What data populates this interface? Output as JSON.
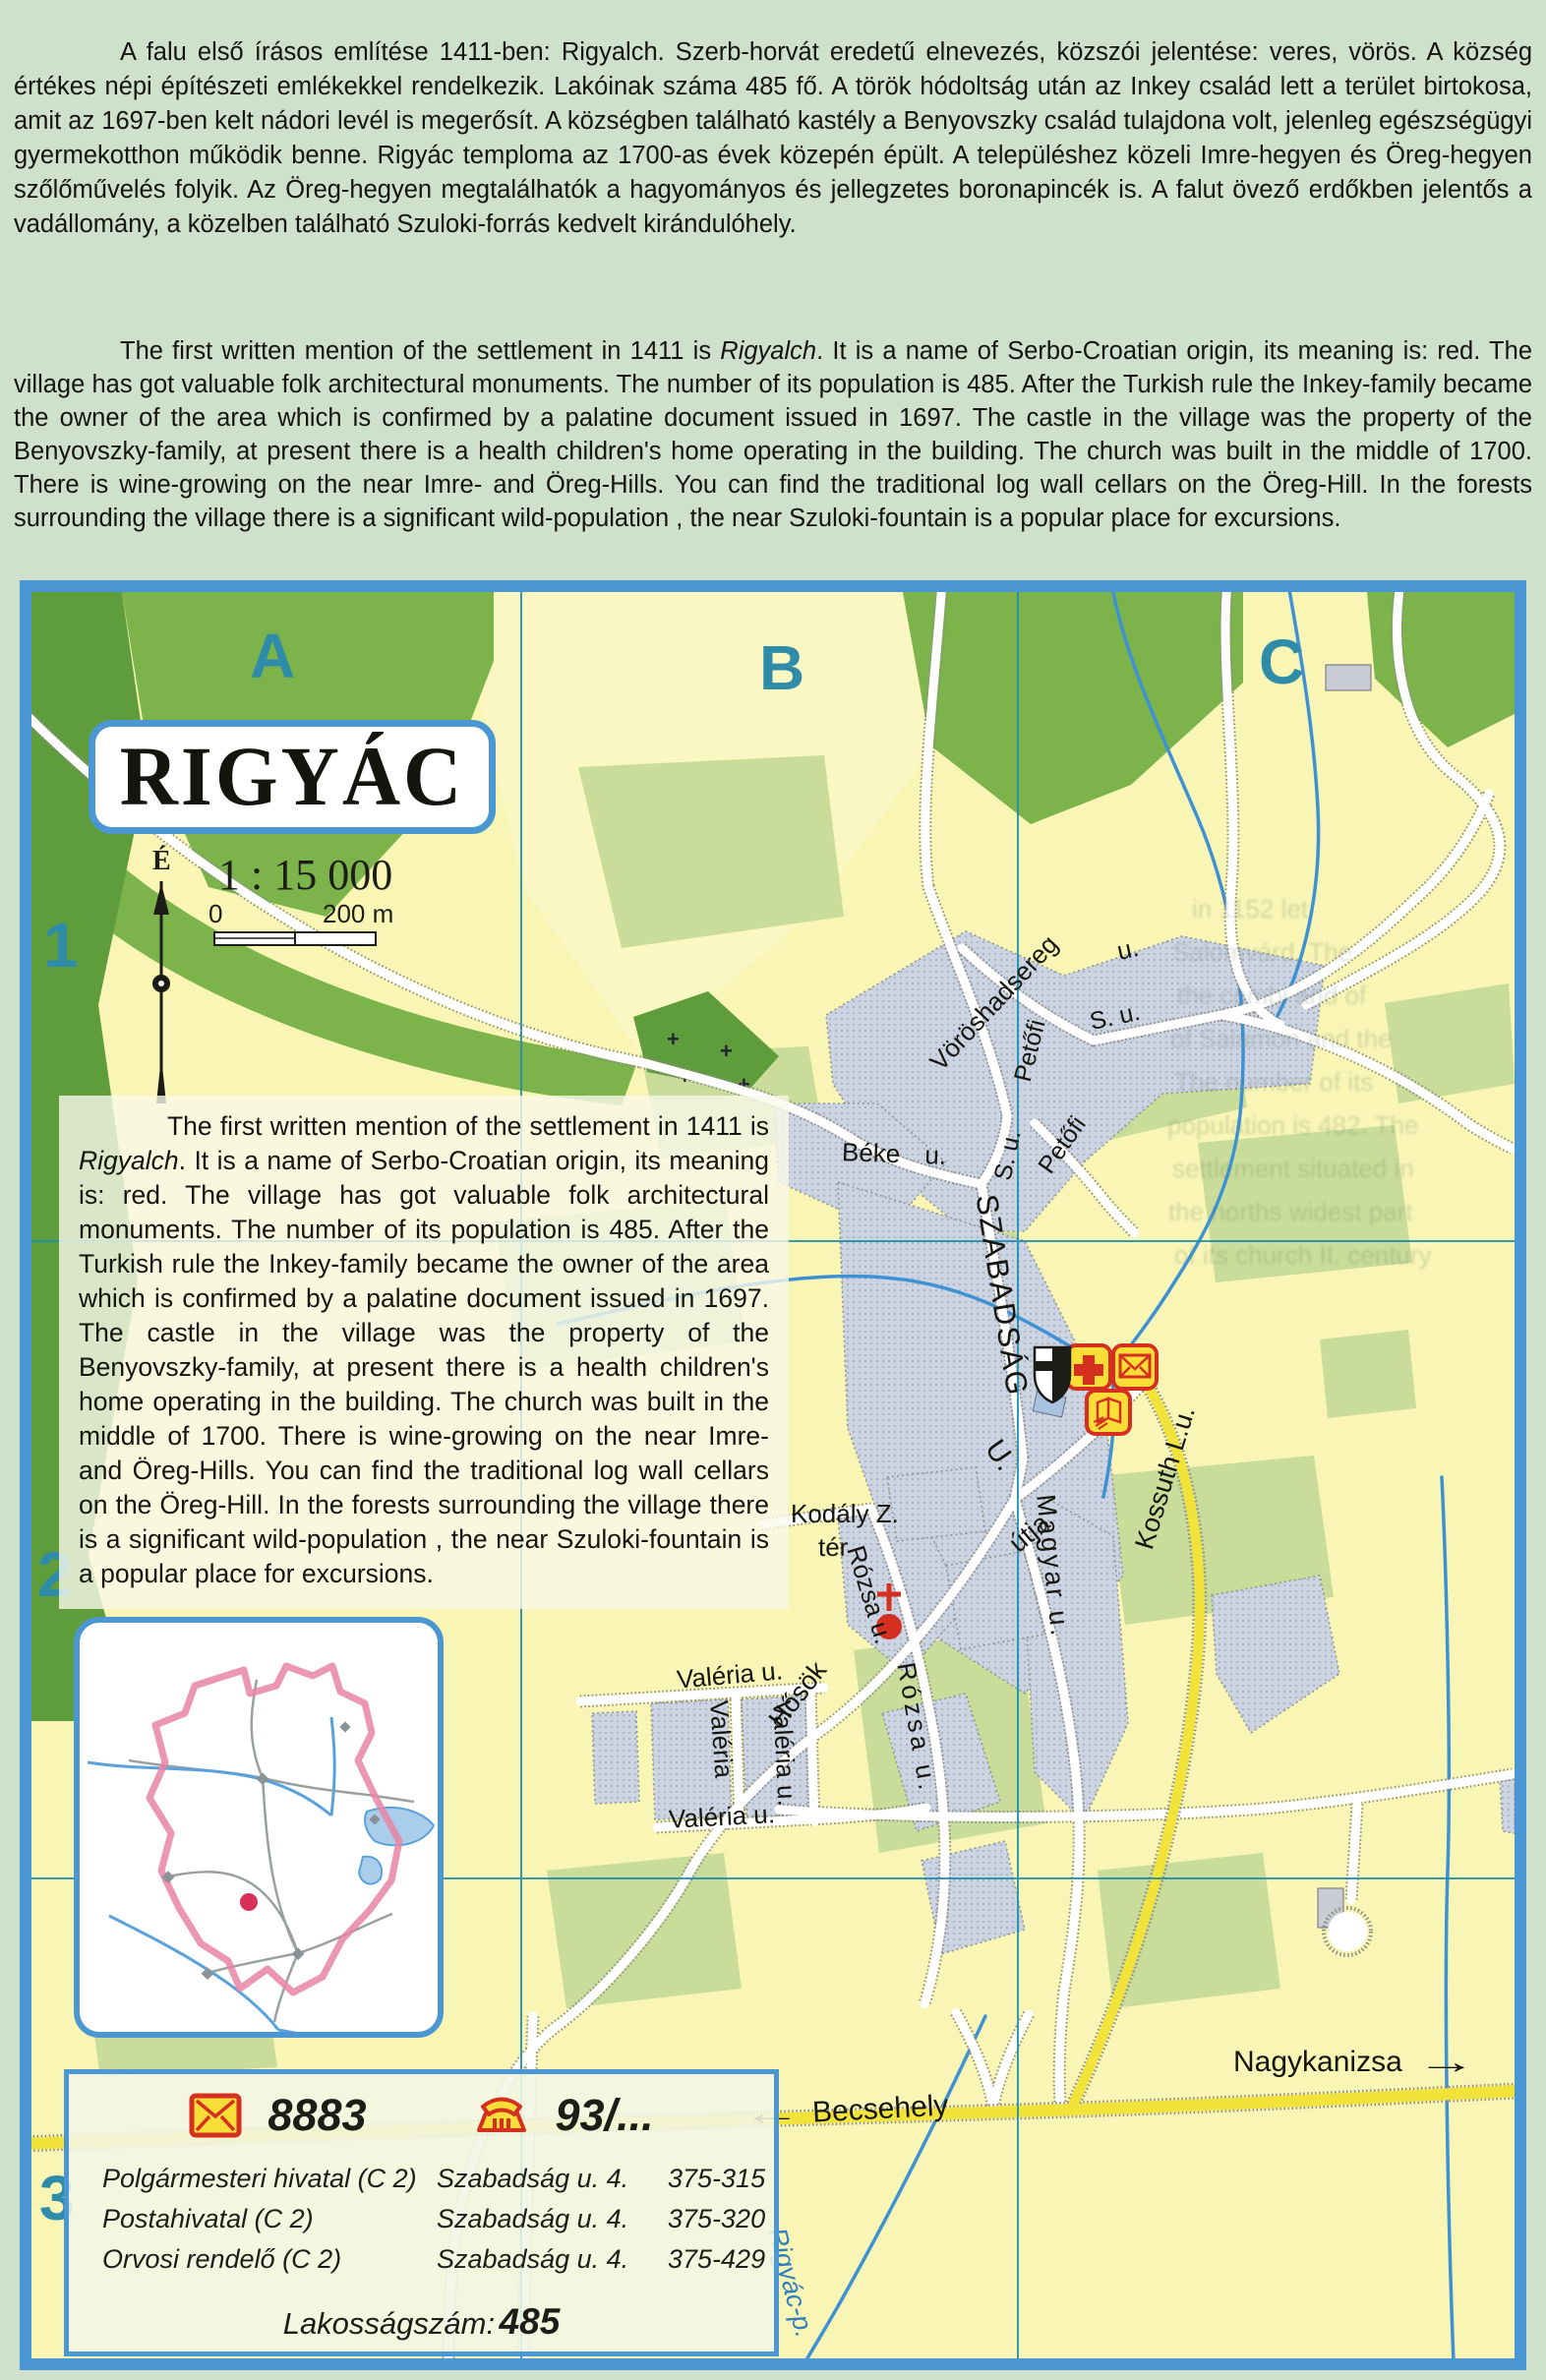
{
  "intro_hu": {
    "text": "A falu első írásos említése 1411-ben: Rigyalch. Szerb-horvát eredetű elnevezés, közszói jelentése: veres, vörös. A község értékes népi építészeti emlékekkel rendelkezik. Lakóinak száma 485 fő. A török hódoltság után az Inkey család lett a terület birtokosa, amit az 1697-ben kelt nádori levél is megerősít. A községben található kastély a Benyovszky család tulajdona volt, jelenleg egészségügyi gyermekotthon működik benne. Rigyác temploma az 1700-as évek közepén épült. A településhez közeli Imre-hegyen és Öreg-hegyen szőlőművelés folyik. Az Öreg-hegyen megtalálhatók a hagyományos és jellegzetes boronapincék is. A falut övező erdőkben jelentős a vadállomány, a közelben található Szuloki-forrás kedvelt kirándulóhely."
  },
  "intro_en": {
    "pre": "The first written mention of the settlement in 1411 is ",
    "italic": "Rigyalch",
    "post": ". It is a name of Serbo-Croatian origin, its meaning is: red. The village has got valuable folk architectural monuments. The number of its population is 485. After the Turkish rule the Inkey-family became the owner of the area which is confirmed by a palatine document issued in 1697. The castle in the village was the property of the Benyovszky-family, at present there is a health children's home operating in the building. The church was built in the middle of 1700. There is wine-growing on the near Imre- and Öreg-Hills. You can find the traditional log wall cellars on the Öreg-Hill. In the forests surrounding the village there is a significant wild-population , the near Szuloki-fountain is a popular place for excursions."
  },
  "map": {
    "title": "RIGYÁC",
    "scale_text": "1 : 15 000",
    "scale_zero": "0",
    "scale_end": "200 m",
    "north_label": "É",
    "grid": {
      "cols": [
        "A",
        "B",
        "C"
      ],
      "rows": [
        "1",
        "2",
        "3"
      ]
    },
    "streets": {
      "voroshadsereg": "Vöröshadsereg",
      "voros_u": "u.",
      "petofi1": "Petőfi",
      "petofi1_su": "S. u.",
      "petofi2": "Petőfi",
      "petofi2_su": "S. u.",
      "beke": "Béke  u.",
      "szabadsag": "SZABADSÁG",
      "szabadsag_u": "U.",
      "utja": "útja",
      "magyar": "Magyar u.",
      "kossuth": "Kossuth L.u.",
      "kodaly1": "Kodály Z.",
      "kodaly2": "tér",
      "rozsa1": "Rózsa u.",
      "rozsa2": "Rózsa u.",
      "valeria_top": "Valéria u.",
      "valeria_v1": "Valéria",
      "valeria_v2": "Valéria u.",
      "valeria_bottom": "Valéria u.",
      "hosok": "Hősök"
    },
    "directions": {
      "west": "Becsehely",
      "east": "Nagykanizsa",
      "arrow_left": "←",
      "arrow_right": "→"
    },
    "stream_label": "Rigyác-p.",
    "ghost_lines": [
      "in 1152 let",
      "Salomvárd. The",
      "the combi and of",
      "of Salamon and the",
      "The number of its",
      "population is 482. The",
      "settlement situated in",
      "the norths widest part",
      "of its church II. century"
    ]
  },
  "info_box": {
    "postal_code": "8883",
    "phone_code": "93/...",
    "entries": [
      {
        "name": "Polgármesteri hivatal (C 2)",
        "address": "Szabadság u. 4.",
        "phone": "375-315"
      },
      {
        "name": "Postahivatal (C 2)",
        "address": "Szabadság u. 4.",
        "phone": "375-320"
      },
      {
        "name": "Orvosi rendelő (C 2)",
        "address": "Szabadság u. 4.",
        "phone": "375-429"
      }
    ],
    "population_label": "Lakosságszám:",
    "population_value": "485"
  },
  "colors": {
    "accent_blue": "#4a97d3",
    "teal": "#2e8ca8",
    "road_yellow": "#f2e33b",
    "forest": "#7cb34b",
    "forest_dark": "#5f9d3c",
    "field": "#c9dc99",
    "builtup": "#ccd4e2",
    "symbol_red": "#d5301f",
    "boundary_pink": "#e884a4",
    "stream_blue": "#3e92d4"
  }
}
